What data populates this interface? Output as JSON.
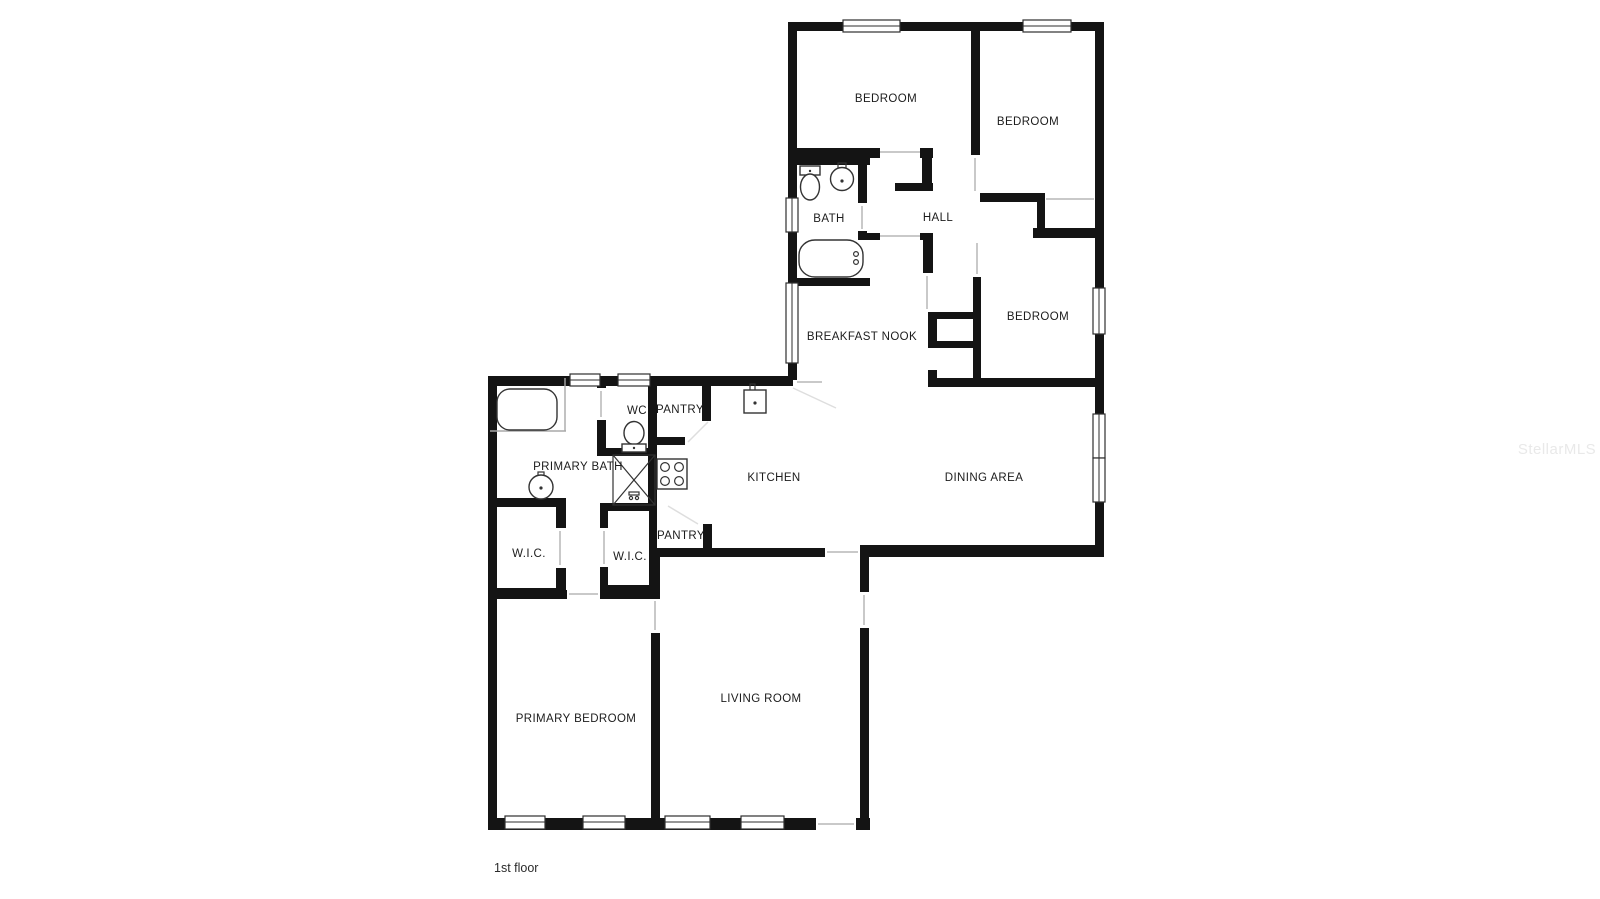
{
  "page": {
    "floor_label": "1st floor",
    "watermark": "StellarMLS",
    "background": "#ffffff"
  },
  "colors": {
    "wall": "#141414",
    "label_text": "#1c1c1c",
    "watermark_text": "#e9e9e9",
    "fixture_stroke": "#333333"
  },
  "rooms": [
    {
      "id": "bedroom-1",
      "label": "BEDROOM"
    },
    {
      "id": "bedroom-2",
      "label": "BEDROOM"
    },
    {
      "id": "bedroom-3",
      "label": "BEDROOM"
    },
    {
      "id": "bath",
      "label": "BATH"
    },
    {
      "id": "hall",
      "label": "HALL"
    },
    {
      "id": "breakfast-nook",
      "label": "BREAKFAST NOOK"
    },
    {
      "id": "wc",
      "label": "WC"
    },
    {
      "id": "pantry-upper",
      "label": "PANTRY"
    },
    {
      "id": "kitchen",
      "label": "KITCHEN"
    },
    {
      "id": "dining-area",
      "label": "DINING AREA"
    },
    {
      "id": "primary-bath",
      "label": "PRIMARY BATH"
    },
    {
      "id": "wic-left",
      "label": "W.I.C."
    },
    {
      "id": "wic-right",
      "label": "W.I.C."
    },
    {
      "id": "pantry-lower",
      "label": "PANTRY"
    },
    {
      "id": "primary-bedroom",
      "label": "PRIMARY BEDROOM"
    },
    {
      "id": "living-room",
      "label": "LIVING ROOM"
    }
  ],
  "fixtures": [
    {
      "name": "toilet-icon",
      "room": "bath"
    },
    {
      "name": "sink-icon",
      "room": "bath"
    },
    {
      "name": "bathtub-icon",
      "room": "bath"
    },
    {
      "name": "bathtub-icon",
      "room": "primary-bath"
    },
    {
      "name": "sink-icon",
      "room": "primary-bath"
    },
    {
      "name": "shower-icon",
      "room": "primary-bath"
    },
    {
      "name": "toilet-icon",
      "room": "wc"
    },
    {
      "name": "kitchen-sink-icon",
      "room": "kitchen"
    },
    {
      "name": "stove-icon",
      "room": "kitchen"
    }
  ]
}
